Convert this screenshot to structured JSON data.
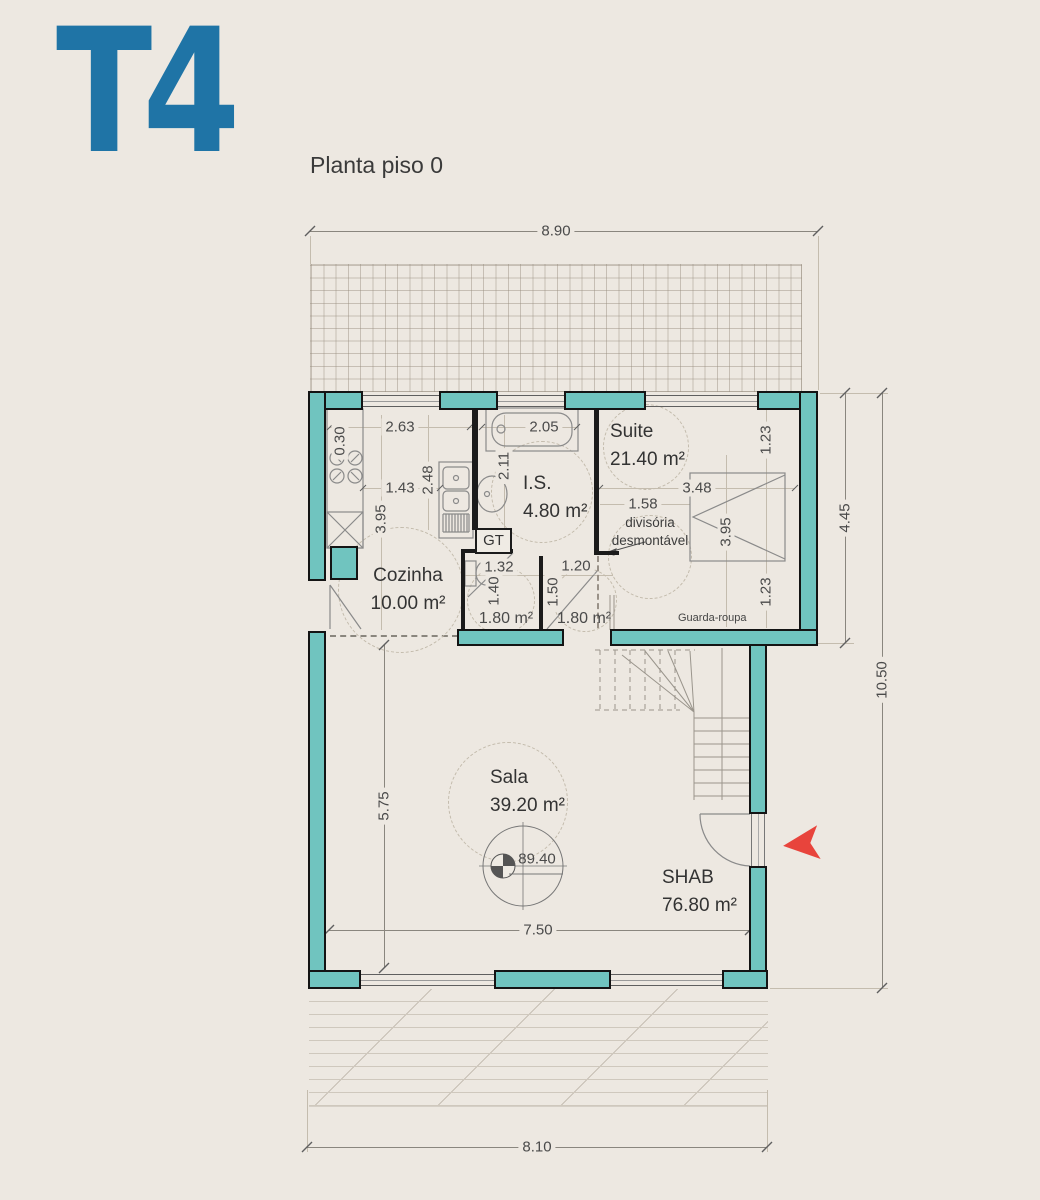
{
  "header": {
    "logo": "T4",
    "subtitle": "Planta piso 0"
  },
  "colors": {
    "background": "#EDE8E1",
    "wall_teal": "#70C4BF",
    "wall_outline": "#141414",
    "logo_blue": "#1F74A6",
    "arrow_red": "#E8443C",
    "dim_text": "#4a4a4a"
  },
  "rooms": {
    "cozinha": {
      "name": "Cozinha",
      "area": "10.00 m²"
    },
    "is": {
      "name": "I.S.",
      "area": "4.80 m²"
    },
    "suite": {
      "name": "Suite",
      "area": "21.40 m²"
    },
    "sala": {
      "name": "Sala",
      "area": "39.20 m²"
    },
    "shab": {
      "name": "SHAB",
      "area": "76.80  m²"
    }
  },
  "annotations": {
    "gt": "GT",
    "guarda_roupa": "Guarda-roupa",
    "divisoria_line1": "divisória",
    "divisoria_line2": "desmontável",
    "level_mark": "89.40",
    "wc_area": "1.80 m²",
    "hall_area": "1.80 m²"
  },
  "dims": {
    "overall_top": "8.90",
    "right_upper": "4.45",
    "right_total": "10.50",
    "overall_bottom": "8.10",
    "sala_width": "7.50",
    "sala_height": "5.75",
    "kitchen_width": "2.63",
    "kitchen_counter": "0.30",
    "kitchen_a": "1.43",
    "kitchen_b": "2.48",
    "kitchen_height": "3.95",
    "is_width": "2.05",
    "is_height": "2.11",
    "suite_top": "1.23",
    "suite_width": "3.48",
    "suite_a": "1.58",
    "suite_height": "3.95",
    "suite_bottom": "1.23",
    "wc_width": "1.32",
    "wc_height": "1.40",
    "hall_width": "1.20",
    "hall_height": "1.50"
  }
}
